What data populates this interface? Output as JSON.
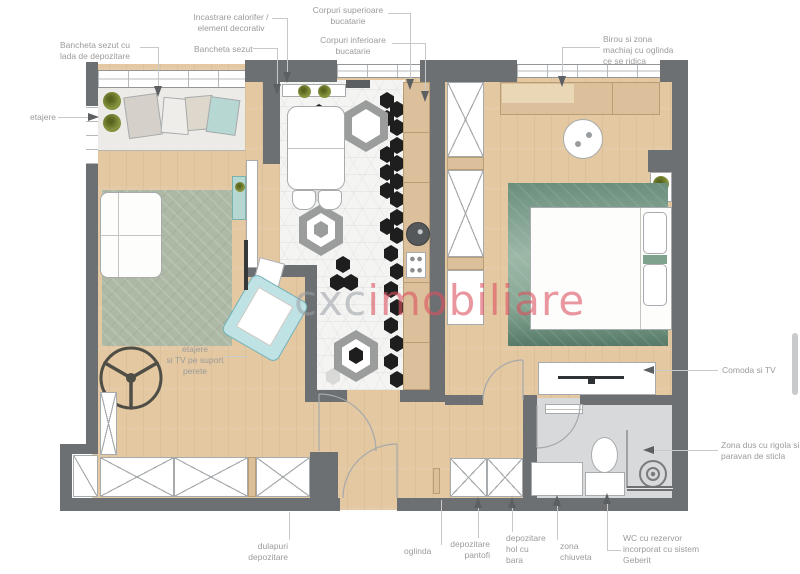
{
  "labels": {
    "bancheta_lada": "Bancheta sezut cu\nlada de depozitare",
    "incastrare": "Incastrare calorifer /\nelement decorativ",
    "bancheta_sezut": "Bancheta sezut",
    "corpuri_sup": "Corpuri superioare\nbucatarie",
    "corpuri_inf": "Corpuri inferioare\nbucatarie",
    "birou": "Birou si zona\nmachiaj cu oglinda\nce se ridica",
    "etajere": "etajere",
    "etajere_tv": "etajere\nsi TV pe suport\nperete",
    "comoda_tv": "Comoda si TV",
    "zona_dus": "Zona dus cu rigola si\nparavan de sticla",
    "wc": "WC cu rezervor\nincorporat cu sistem\nGeberit",
    "zona_chiuveta": "zona\nchiuveta",
    "dep_hol": "depozitare\nhol cu\nbara",
    "dep_pantofi": "depozitare\npantofi",
    "oglinda": "oglinda",
    "dulapuri": "dulapuri\ndepozitare"
  },
  "watermark": {
    "left": "cxc",
    "right": "imobiliare"
  },
  "icons": [
    "ceiling-fan-icon",
    "shower-head-icon",
    "toilet-icon",
    "plant-icon",
    "sink-icon",
    "tv-icon",
    "hob-icon"
  ],
  "colors": {
    "wall": "#6d7072",
    "wood": "#e3c8a2",
    "rugliving": "#adb9a5",
    "rugbeda": "#6b8f7d",
    "rugbedb": "#9cb8a7",
    "rugbedc": "#567a68",
    "hexwhite": "#f4f4f3",
    "hexblack": "#1e1e1e",
    "hexgray": "#9b9d9c",
    "bathfloor": "#d7d9da",
    "furnborder": "#a8abad",
    "tan": "#dcc09b",
    "teal": "#b6d7d2",
    "tealchair": "#bfe2e4",
    "benchfill": "#ecebe7",
    "labelc": "#9b9b9b",
    "leader": "#c6c8ca",
    "arrow": "#5c6062",
    "wmgray": "#9aa0a4",
    "wmred": "#dd5260"
  }
}
